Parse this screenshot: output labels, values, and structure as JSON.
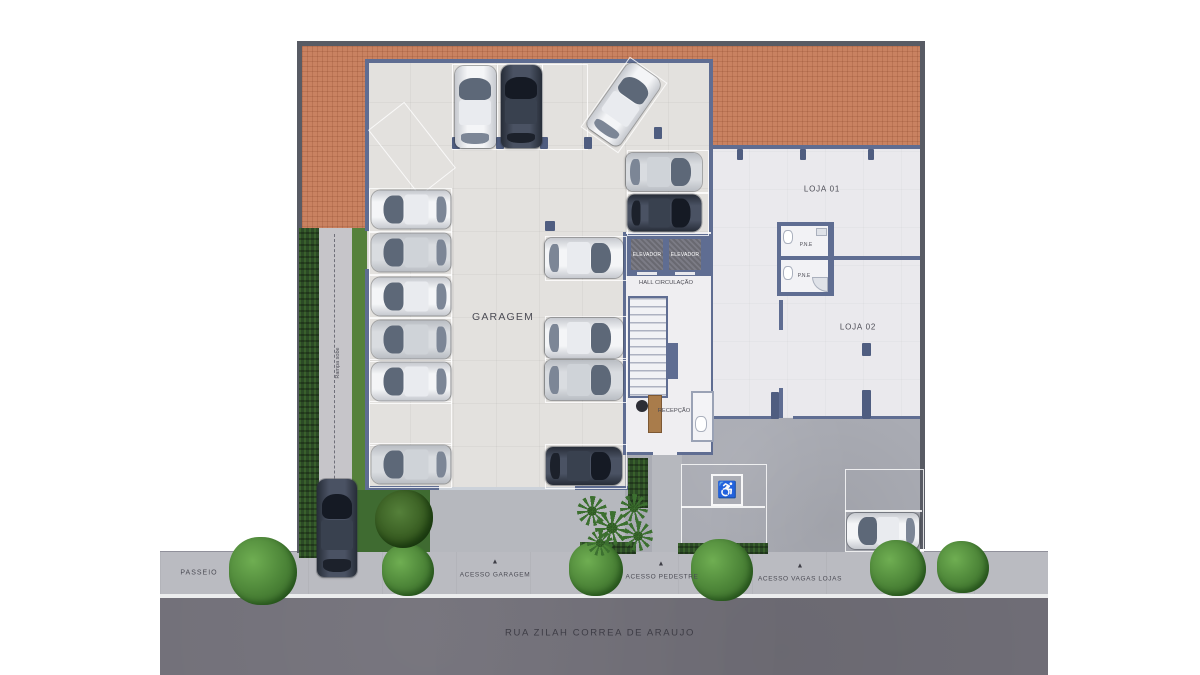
{
  "scene": {
    "type": "residential-building-ground-floor-plan-top-view",
    "street": {
      "name": "RUA ZILAH CORREA DE ARAUJO",
      "sidewalk_label": "PASSEIO"
    },
    "access_points": {
      "garage": "ACESSO GARAGEM",
      "pedestrian": "ACESSO PEDESTRE",
      "shop_parking": "ACESSO VAGAS LOJAS"
    },
    "rooms": {
      "garage": "GARAGEM",
      "shop_1": "LOJA 01",
      "shop_2": "LOJA 02",
      "hall": "HALL CIRCULAÇÃO",
      "reception": "RECEPÇÃO",
      "elevator": "ELEVADOR",
      "accessible_wc": "P.N.E",
      "ramp": "Rampa sobe"
    },
    "icons": {
      "access_arrow": "▲",
      "wheelchair": "♿"
    },
    "colors": {
      "terracotta": "#c98261",
      "garage_floor": "#e3e1de",
      "shop_floor": "#eae9ed",
      "plaza": "#a9abb3",
      "street": "#716f78",
      "sidewalk": "#babbc1",
      "wall": "#5f6d92",
      "boundary": "#585b64",
      "hedge": "#2c4a26",
      "lawn": "#3f6b31"
    },
    "cars": [
      {
        "cx": 475,
        "cy": 107,
        "len": 82,
        "wid": 41,
        "rot": 0,
        "color": "white"
      },
      {
        "cx": 521,
        "cy": 106,
        "len": 83,
        "wid": 41,
        "rot": 0,
        "color": "dark"
      },
      {
        "cx": 624,
        "cy": 104,
        "len": 80,
        "wid": 40,
        "rot": 35,
        "color": "white"
      },
      {
        "cx": 411,
        "cy": 209,
        "len": 79,
        "wid": 38,
        "rot": -90,
        "color": "white"
      },
      {
        "cx": 411,
        "cy": 252,
        "len": 79,
        "wid": 38,
        "rot": -90,
        "color": "silver"
      },
      {
        "cx": 411,
        "cy": 296,
        "len": 79,
        "wid": 38,
        "rot": -90,
        "color": "white"
      },
      {
        "cx": 411,
        "cy": 339,
        "len": 79,
        "wid": 38,
        "rot": -90,
        "color": "silver"
      },
      {
        "cx": 411,
        "cy": 381,
        "len": 79,
        "wid": 38,
        "rot": -90,
        "color": "white"
      },
      {
        "cx": 411,
        "cy": 464,
        "len": 79,
        "wid": 38,
        "rot": -90,
        "color": "silver"
      },
      {
        "cx": 584,
        "cy": 258,
        "len": 78,
        "wid": 40,
        "rot": 90,
        "color": "white"
      },
      {
        "cx": 584,
        "cy": 338,
        "len": 78,
        "wid": 40,
        "rot": 90,
        "color": "white"
      },
      {
        "cx": 584,
        "cy": 380,
        "len": 78,
        "wid": 40,
        "rot": 90,
        "color": "silver"
      },
      {
        "cx": 584,
        "cy": 466,
        "len": 76,
        "wid": 38,
        "rot": 90,
        "color": "dark"
      },
      {
        "cx": 664,
        "cy": 172,
        "len": 76,
        "wid": 38,
        "rot": 90,
        "color": "silver"
      },
      {
        "cx": 664,
        "cy": 213,
        "len": 74,
        "wid": 37,
        "rot": 90,
        "color": "dark"
      },
      {
        "cx": 337,
        "cy": 528,
        "len": 98,
        "wid": 40,
        "rot": 0,
        "color": "dark"
      },
      {
        "cx": 883,
        "cy": 531,
        "len": 72,
        "wid": 36,
        "rot": -90,
        "color": "white"
      }
    ],
    "parking_spots": [
      {
        "x": 452,
        "y": 64,
        "w": 44,
        "h": 84,
        "rot": 0
      },
      {
        "x": 497,
        "y": 64,
        "w": 44,
        "h": 84,
        "rot": 0
      },
      {
        "x": 542,
        "y": 64,
        "w": 44,
        "h": 84,
        "rot": 0
      },
      {
        "x": 601,
        "y": 62,
        "w": 44,
        "h": 84,
        "rot": 35
      },
      {
        "x": 389,
        "y": 107,
        "w": 44,
        "h": 82,
        "rot": -38
      },
      {
        "x": 369,
        "y": 188,
        "w": 81,
        "h": 43,
        "rot": 0
      },
      {
        "x": 369,
        "y": 231,
        "w": 81,
        "h": 43,
        "rot": 0
      },
      {
        "x": 369,
        "y": 274,
        "w": 81,
        "h": 43,
        "rot": 0
      },
      {
        "x": 369,
        "y": 317,
        "w": 81,
        "h": 43,
        "rot": 0
      },
      {
        "x": 369,
        "y": 359,
        "w": 81,
        "h": 43,
        "rot": 0
      },
      {
        "x": 369,
        "y": 401,
        "w": 81,
        "h": 43,
        "rot": 0
      },
      {
        "x": 369,
        "y": 443,
        "w": 81,
        "h": 43,
        "rot": 0
      },
      {
        "x": 545,
        "y": 236,
        "w": 80,
        "h": 43,
        "rot": 0
      },
      {
        "x": 545,
        "y": 316,
        "w": 80,
        "h": 43,
        "rot": 0
      },
      {
        "x": 545,
        "y": 358,
        "w": 80,
        "h": 43,
        "rot": 0
      },
      {
        "x": 545,
        "y": 444,
        "w": 80,
        "h": 43,
        "rot": 0
      },
      {
        "x": 627,
        "y": 150,
        "w": 80,
        "h": 42,
        "rot": 0
      },
      {
        "x": 627,
        "y": 192,
        "w": 80,
        "h": 42,
        "rot": 0
      }
    ],
    "columns": [
      {
        "x": 452,
        "y": 137,
        "w": 8,
        "h": 12
      },
      {
        "x": 496,
        "y": 137,
        "w": 8,
        "h": 12
      },
      {
        "x": 540,
        "y": 137,
        "w": 8,
        "h": 12
      },
      {
        "x": 584,
        "y": 137,
        "w": 8,
        "h": 12
      },
      {
        "x": 654,
        "y": 127,
        "w": 8,
        "h": 12
      },
      {
        "x": 545,
        "y": 221,
        "w": 10,
        "h": 10
      },
      {
        "x": 737,
        "y": 149,
        "w": 6,
        "h": 11
      },
      {
        "x": 800,
        "y": 149,
        "w": 6,
        "h": 11
      },
      {
        "x": 868,
        "y": 149,
        "w": 6,
        "h": 11
      },
      {
        "x": 862,
        "y": 343,
        "w": 9,
        "h": 13
      },
      {
        "x": 771,
        "y": 392,
        "w": 8,
        "h": 27
      },
      {
        "x": 862,
        "y": 390,
        "w": 9,
        "h": 29
      }
    ],
    "bushes": [
      {
        "cx": 263,
        "cy": 571,
        "s": 68
      },
      {
        "cx": 408,
        "cy": 570,
        "s": 52
      },
      {
        "cx": 596,
        "cy": 569,
        "s": 54
      },
      {
        "cx": 722,
        "cy": 570,
        "s": 62
      },
      {
        "cx": 898,
        "cy": 568,
        "s": 56
      },
      {
        "cx": 963,
        "cy": 567,
        "s": 52
      }
    ],
    "trees": [
      {
        "cx": 404,
        "cy": 519,
        "s": 58
      }
    ],
    "palms": [
      {
        "cx": 592,
        "cy": 511,
        "s": 30
      },
      {
        "cx": 612,
        "cy": 528,
        "s": 34
      },
      {
        "cx": 634,
        "cy": 508,
        "s": 28
      },
      {
        "cx": 600,
        "cy": 543,
        "s": 26
      },
      {
        "cx": 638,
        "cy": 536,
        "s": 30
      }
    ]
  }
}
